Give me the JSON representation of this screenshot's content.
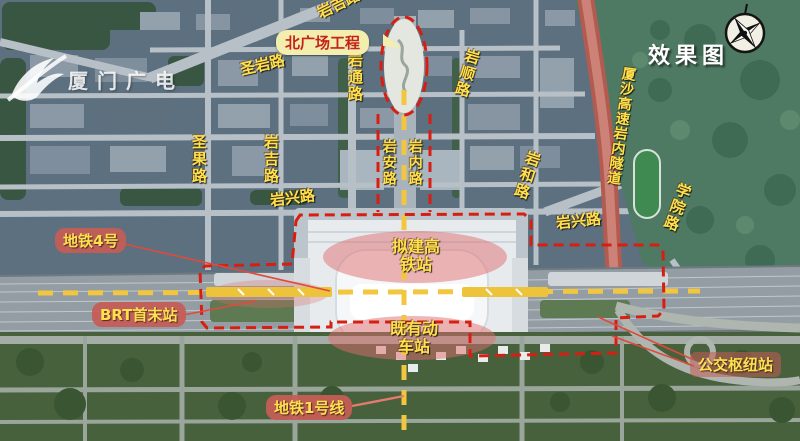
{
  "header": {
    "title": "效果图",
    "brand": "厦门广电"
  },
  "roads": {
    "yanji_top": "岩吉路",
    "shengyan": "圣岩路",
    "yantong": "岩通路",
    "yanshun": "岩顺路",
    "shengguo": "圣果路",
    "yanji_mid": "岩吉路",
    "yanan": "岩安路",
    "yannei": "岩内路",
    "yanxing_left": "岩兴路",
    "yanhe": "岩和路",
    "xiasha_tunnel": "厦沙高速岩内隧道",
    "yanxing_right": "岩兴路",
    "xueyuan": "学院路"
  },
  "callouts": {
    "north_plaza": "北广场工程",
    "metro_line4": "地铁4号",
    "brt_terminal": "BRT首末站",
    "metro_line1": "地铁1号线",
    "bus_hub": "公交枢纽站",
    "planned_hsr_station": "拟建高铁站",
    "existing_station": "既有动车站"
  },
  "icons": {
    "compass": "compass-rose",
    "logo": "xiamen-media-swoosh"
  },
  "colors": {
    "boundary_red_dash": "#d81e12",
    "label_yellow": "#ffe14d",
    "callout_pink": "#c65c58",
    "plaza_box_bg": "#f3edae",
    "plaza_box_text": "#c3231c",
    "metro_dash_yellow": "#f2c63e",
    "highway_red": "#b35b50",
    "highlight_pink": "#e07a7a"
  }
}
